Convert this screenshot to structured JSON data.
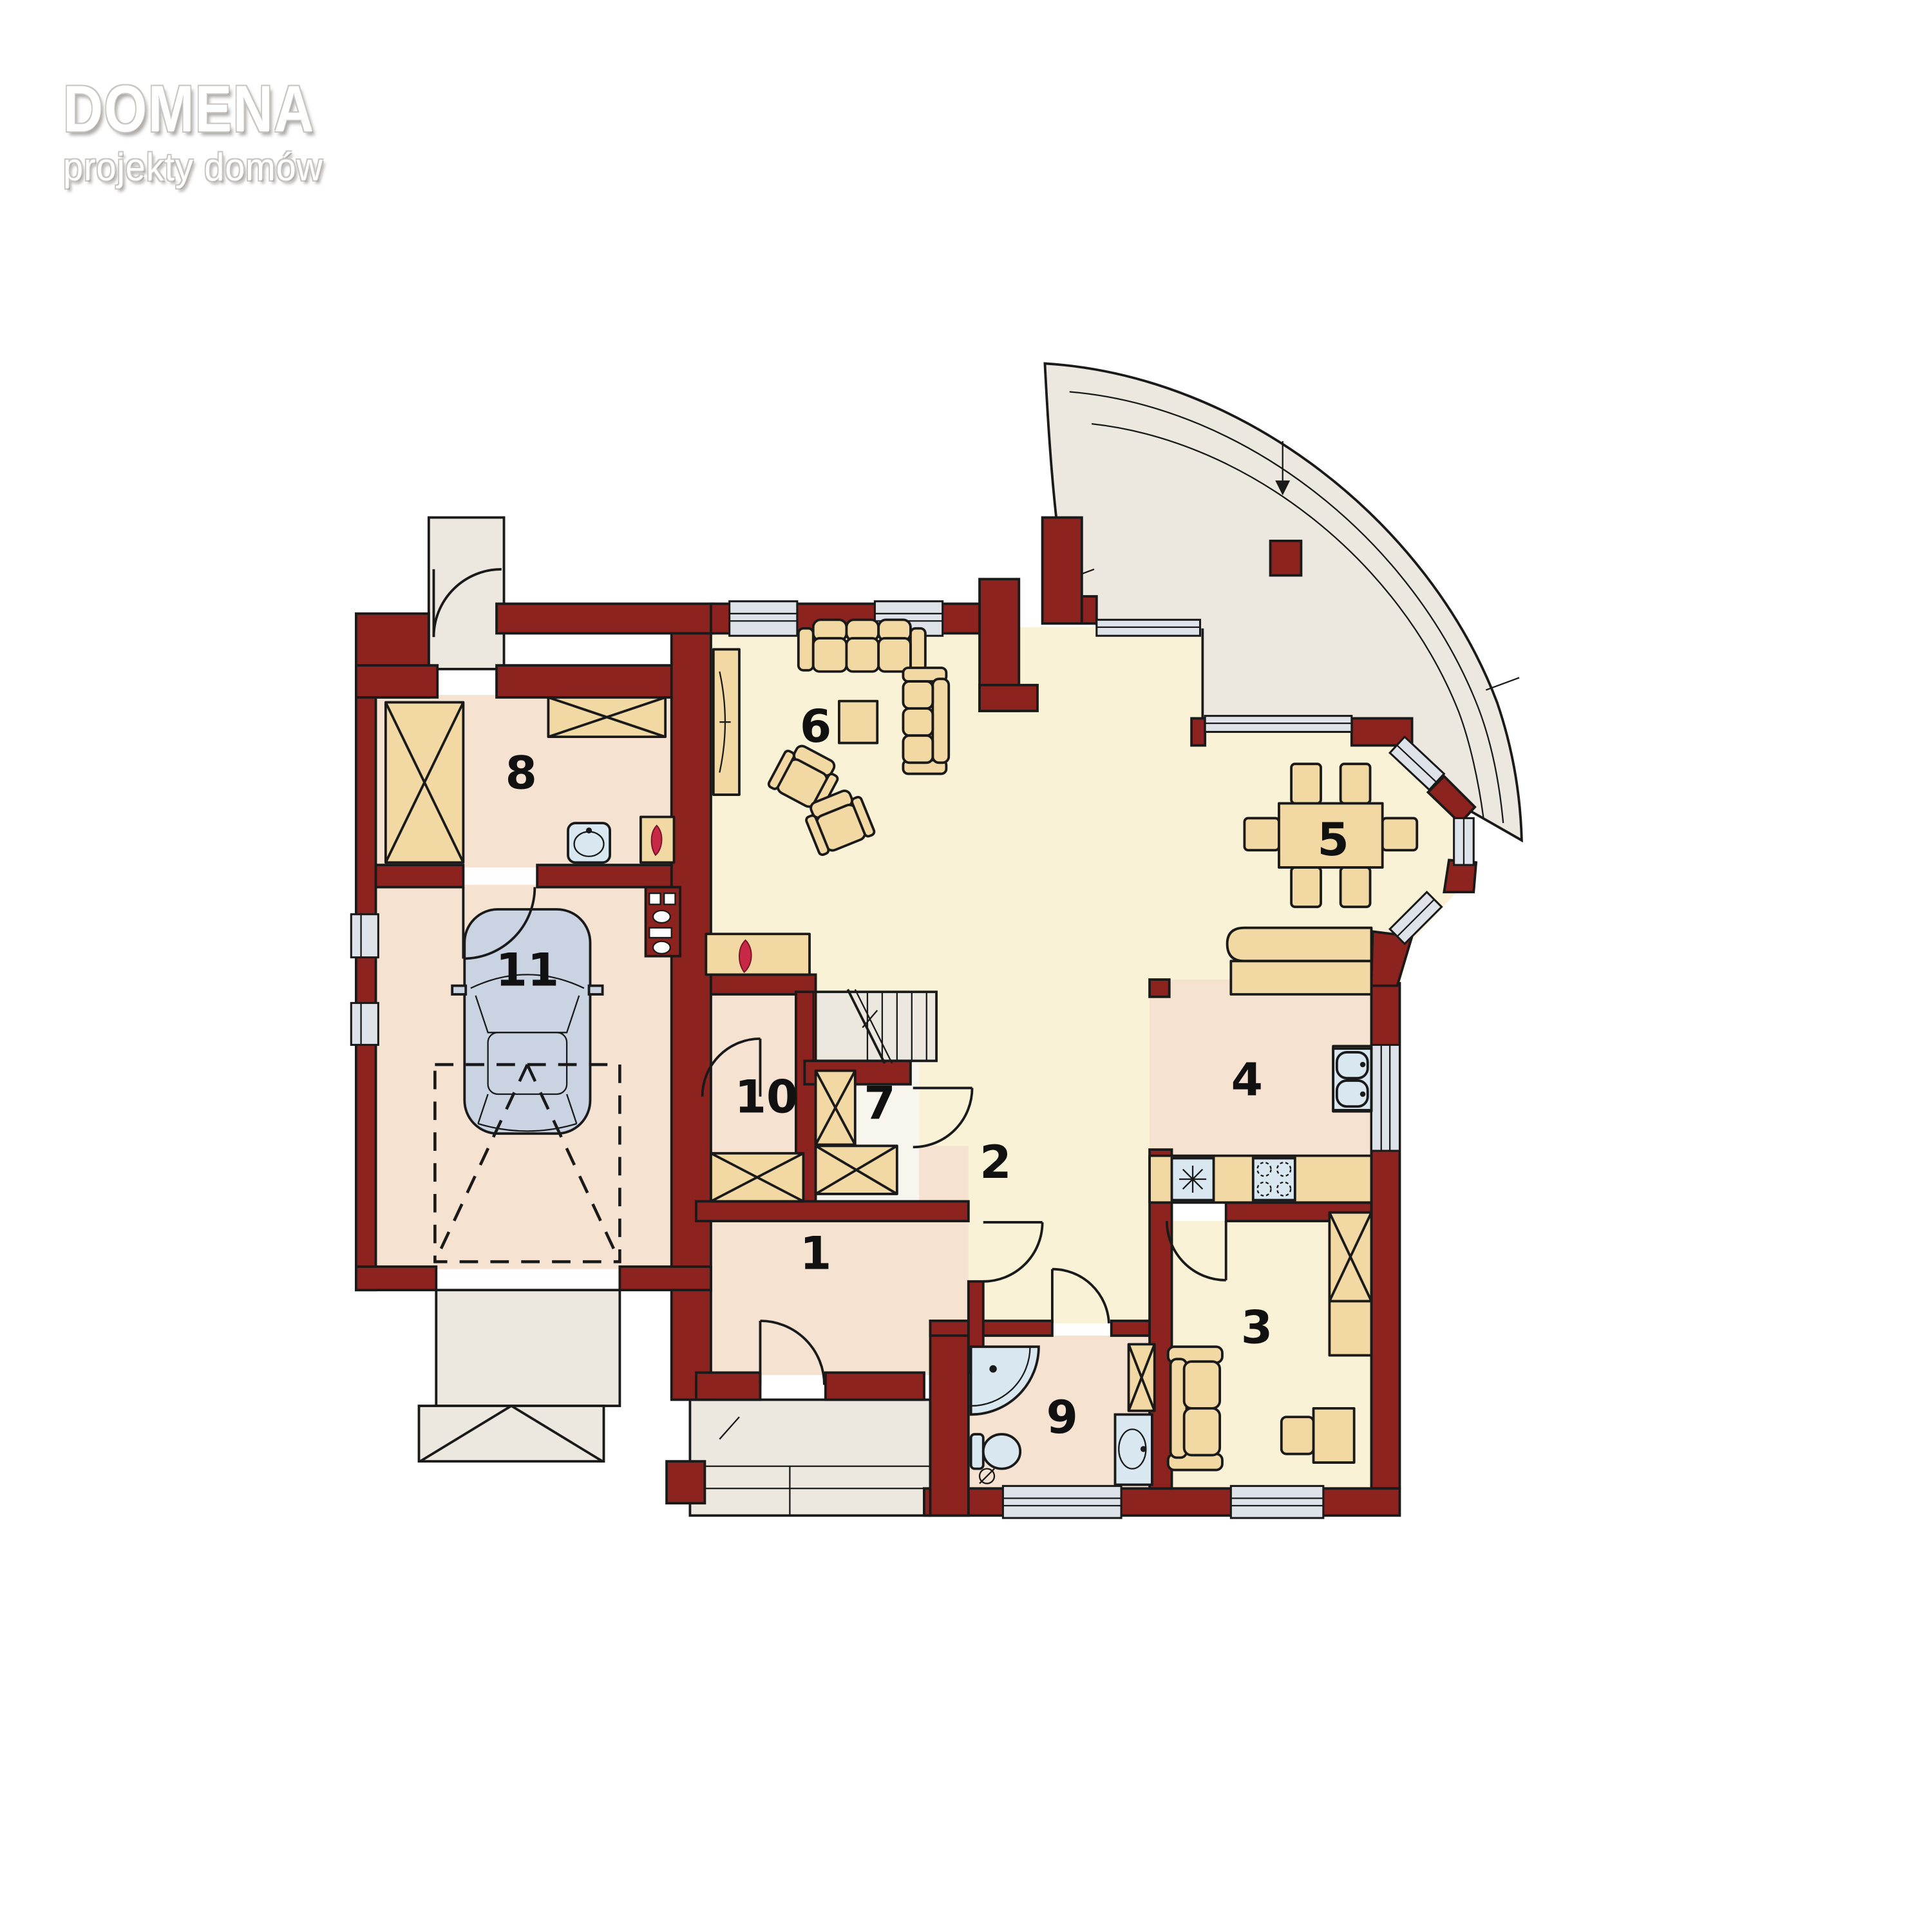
{
  "logo": {
    "title": "DOMENA",
    "subtitle": "projekty domów"
  },
  "rooms": [
    {
      "number": "1"
    },
    {
      "number": "2"
    },
    {
      "number": "3"
    },
    {
      "number": "4"
    },
    {
      "number": "5"
    },
    {
      "number": "6"
    },
    {
      "number": "7"
    },
    {
      "number": "8"
    },
    {
      "number": "9"
    },
    {
      "number": "10"
    },
    {
      "number": "11"
    }
  ],
  "colors": {
    "wall": "#8c231e",
    "floor_cream": "#faf2d6",
    "floor_peach": "#f5e2d0",
    "floor_light": "#f8f5ef",
    "exterior": "#ece8e0",
    "furniture": "#f2d9a4",
    "fixture": "#d9e7f1",
    "window_glass": "#dde3e9",
    "car": "#c9d3e2",
    "flame": "#c62846",
    "outline": "#1a1a1a"
  }
}
